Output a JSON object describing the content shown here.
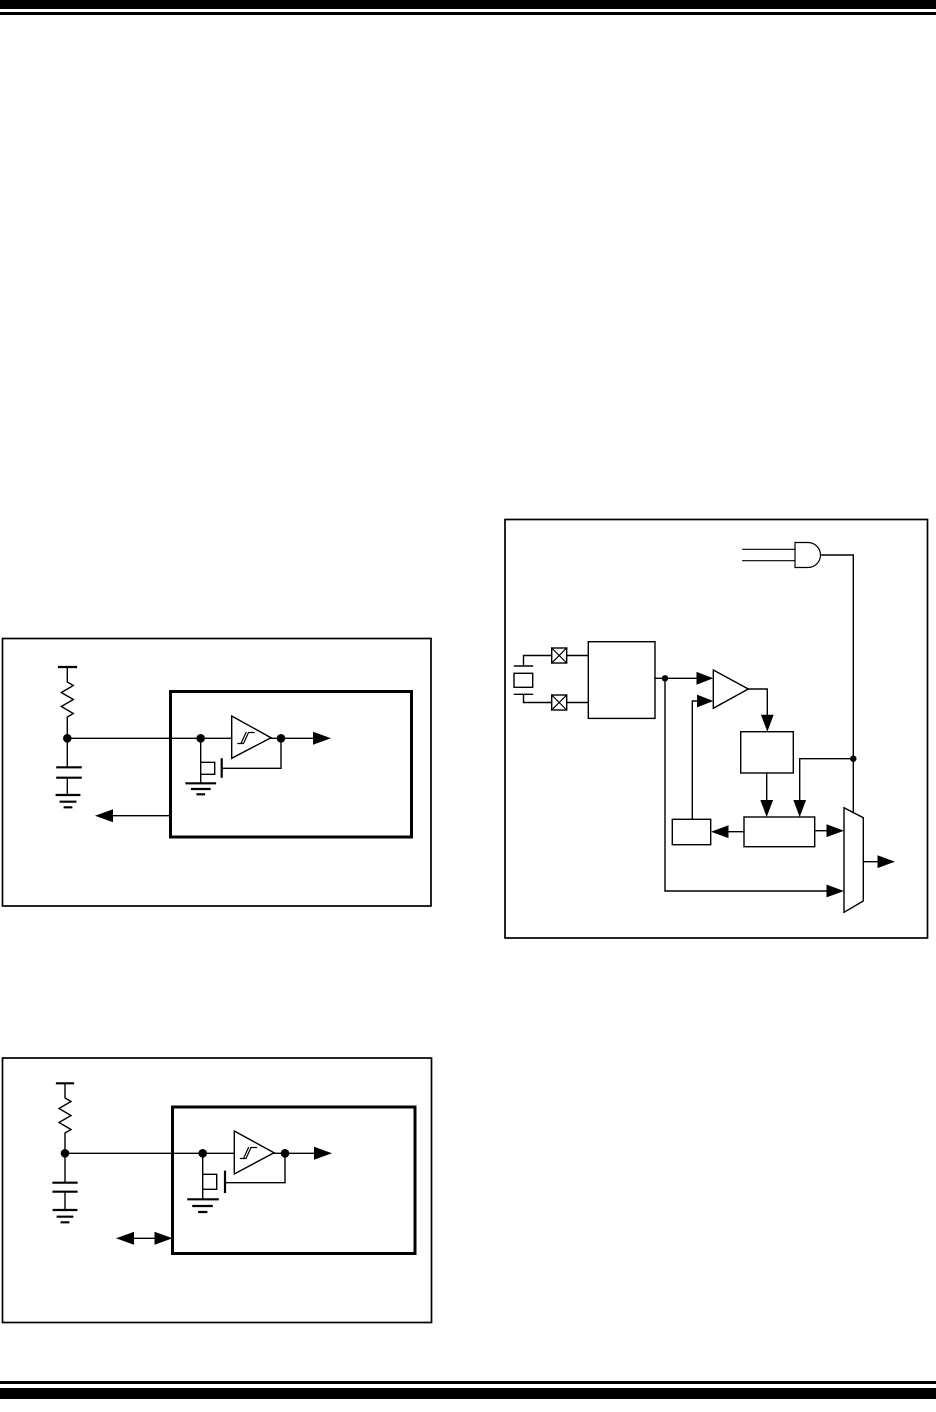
{
  "page": {
    "background": "#ffffff",
    "ink": "#000000",
    "width": 936,
    "height": 1412,
    "visible_text": ""
  },
  "header": {
    "rules": [
      "thick-bar",
      "thin-line"
    ]
  },
  "footer": {
    "rules": [
      "thin-line",
      "thick-bar"
    ]
  },
  "figures": {
    "rc_clock_circuit_top": {
      "type": "schematic",
      "components": [
        "vdd-rail",
        "external-resistor",
        "external-capacitor",
        "ground-symbol",
        "device-boundary-box",
        "schmitt-trigger-buffer",
        "hysteresis-symbol",
        "feedback-mosfet",
        "mosfet-ground",
        "internal-clock-arrow",
        "clkout-arrow-left"
      ]
    },
    "oscillator_block_diagram": {
      "type": "block-diagram",
      "components": [
        "and-gate-2-input",
        "crystal",
        "osc1-pad",
        "osc2-pad",
        "oscillator-block",
        "buffer-triangle",
        "divider-block",
        "wide-register-block",
        "small-block",
        "output-mux",
        "mux-output-arrow",
        "junction-dots"
      ]
    },
    "rc_clock_circuit_bottom": {
      "type": "schematic",
      "components": [
        "vdd-rail",
        "external-resistor",
        "external-capacitor",
        "ground-symbol",
        "device-boundary-box",
        "schmitt-trigger-buffer",
        "hysteresis-symbol",
        "feedback-mosfet",
        "mosfet-ground",
        "internal-clock-arrow",
        "bidirectional-io-arrow"
      ]
    }
  }
}
